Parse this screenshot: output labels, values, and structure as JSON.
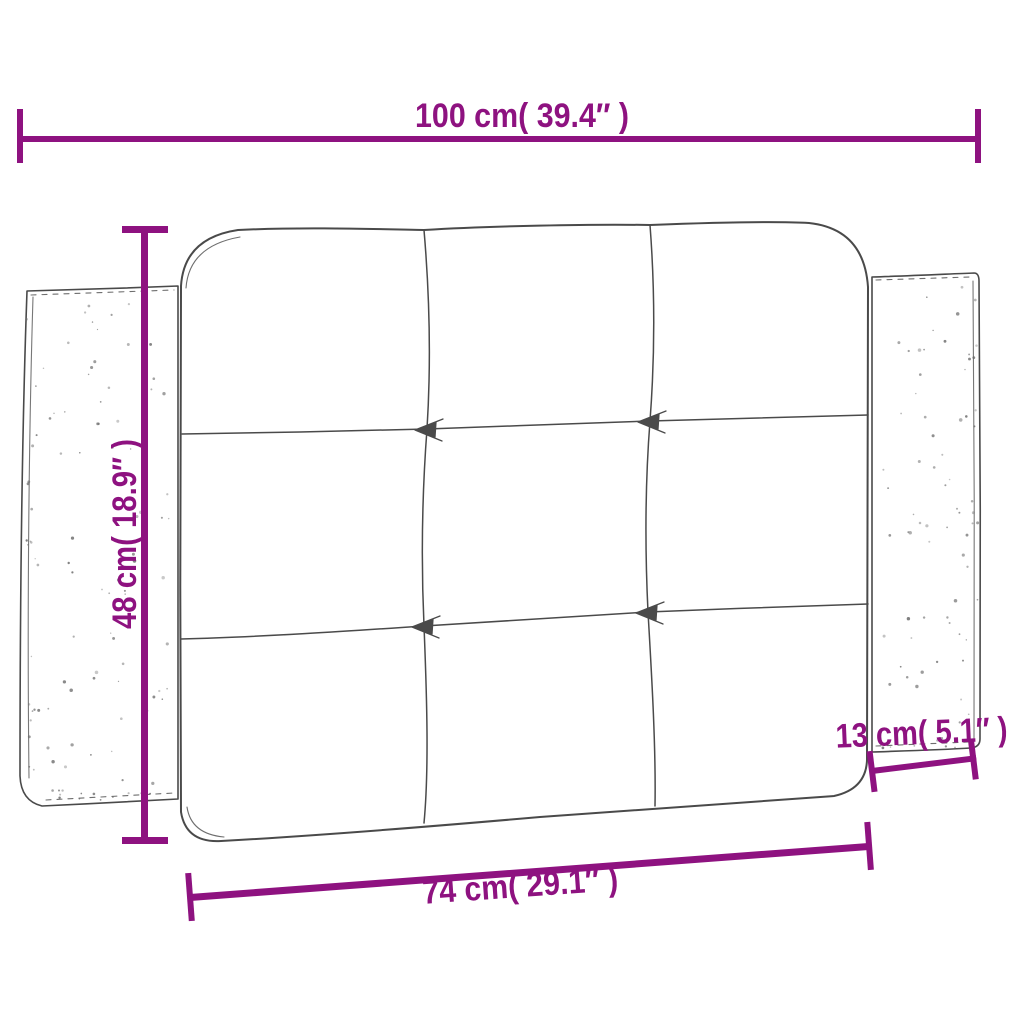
{
  "colors": {
    "dimension": "#8E1280",
    "sketch": "#4A4A4A",
    "speckle": "#6A6A6A"
  },
  "dimensions": {
    "total_width": {
      "label": "100 cm( 39.4″ )",
      "cm": 100,
      "inch": 39.4
    },
    "height": {
      "label": "48 cm( 18.9″ )",
      "cm": 48,
      "inch": 18.9
    },
    "inner_width": {
      "label": "74 cm( 29.1″ )",
      "cm": 74,
      "inch": 29.1
    },
    "side_width": {
      "label": "13 cm( 5.1″ )",
      "cm": 13,
      "inch": 5.1
    }
  },
  "sketch": {
    "subject": "tufted headboard cushion",
    "tuft_rows": 3,
    "tuft_cols": 3
  }
}
